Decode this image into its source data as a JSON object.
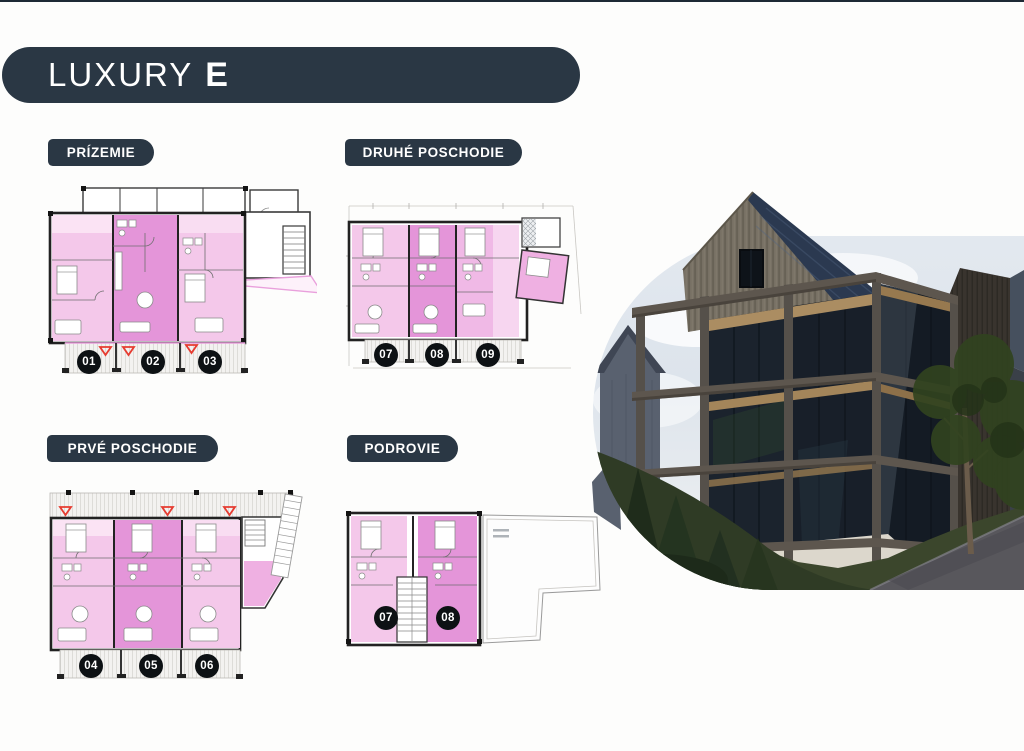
{
  "header": {
    "title_main": "LUXURY",
    "title_suffix": "E"
  },
  "sections": {
    "prizemie": {
      "label": "PRÍZEMIE",
      "badges": [
        "01",
        "02",
        "03"
      ]
    },
    "druhe_poschodie": {
      "label": "DRUHÉ POSCHODIE",
      "badges": [
        "07",
        "08",
        "09"
      ]
    },
    "prve_poschodie": {
      "label": "PRVÉ POSCHODIE",
      "badges": [
        "04",
        "05",
        "06"
      ]
    },
    "podrovie": {
      "label": "PODROVIE",
      "badges": [
        "07",
        "08"
      ]
    }
  },
  "palette": {
    "navy": "#2a3744",
    "badge_black": "#0d1114",
    "unit_pink_light": "#f4c8ea",
    "unit_pink_dark": "#e495d9",
    "marker_red": "#e63b30"
  }
}
